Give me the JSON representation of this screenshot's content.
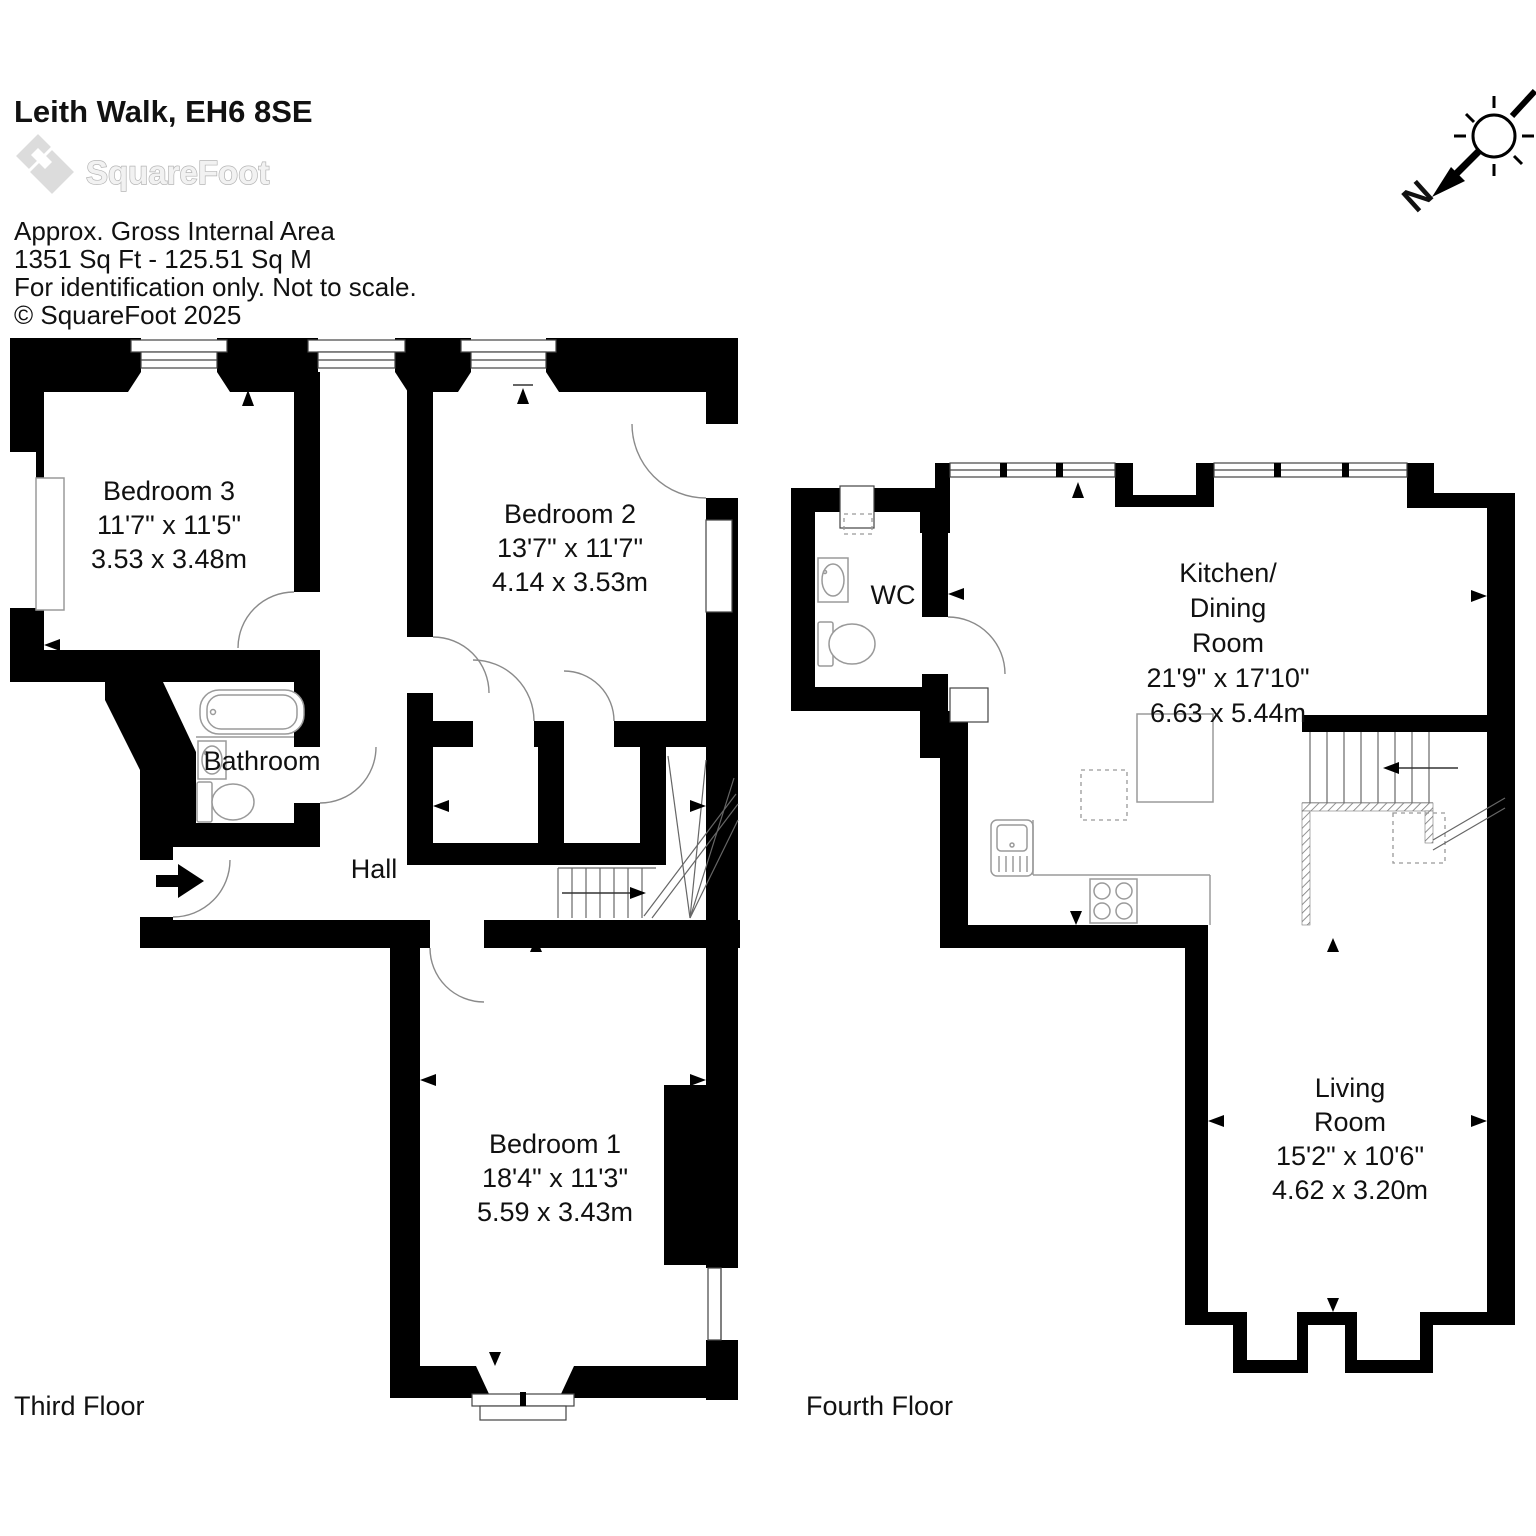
{
  "header": {
    "title": "Leith Walk, EH6 8SE",
    "logo_text": "SquareFoot",
    "area_line1": "Approx. Gross Internal Area",
    "area_line2": "1351 Sq Ft  -  125.51 Sq M",
    "area_line3": "For identification only. Not to scale.",
    "copyright": "© SquareFoot 2025"
  },
  "compass": {
    "north_label": "N"
  },
  "floors": [
    {
      "caption": "Third Floor",
      "rooms": [
        {
          "name": "Bedroom 3",
          "imperial": "11'7\" x 11'5\"",
          "metric": "3.53 x 3.48m"
        },
        {
          "name": "Bedroom 2",
          "imperial": "13'7\" x 11'7\"",
          "metric": "4.14 x 3.53m"
        },
        {
          "name": "Bedroom 1",
          "imperial": "18'4\" x 11'3\"",
          "metric": "5.59 x 3.43m"
        },
        {
          "name": "Bathroom"
        },
        {
          "name": "Hall"
        }
      ]
    },
    {
      "caption": "Fourth Floor",
      "rooms": [
        {
          "name": "WC"
        },
        {
          "name_line1": "Kitchen/",
          "name_line2": "Dining",
          "name_line3": "Room",
          "imperial": "21'9\" x 17'10\"",
          "metric": "6.63 x 5.44m"
        },
        {
          "name_line1": "Living",
          "name_line2": "Room",
          "imperial": "15'2\" x 10'6\"",
          "metric": "4.62 x 3.20m"
        }
      ]
    }
  ],
  "colors": {
    "wall": "#000000",
    "fixture_outline": "#9a9a9a",
    "logo_gray": "#cccccc"
  }
}
